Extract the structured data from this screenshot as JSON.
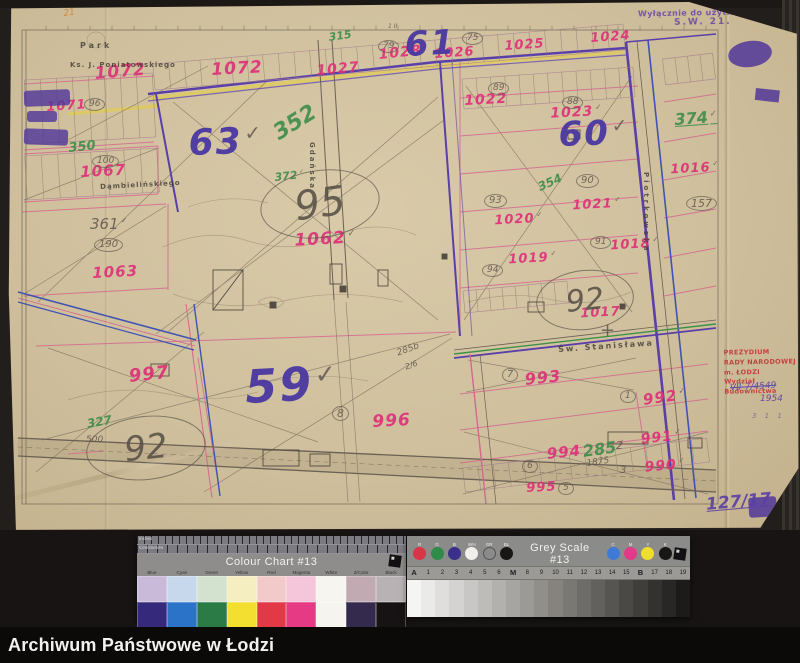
{
  "footer": {
    "archive_name": "Archiwum Państwowe w Łodzi"
  },
  "map": {
    "stamp_service": {
      "line1": "Wyłącznie do użytku służbowego",
      "line2": "S.W. 21."
    },
    "stamp_office": {
      "line1": "PREZYDIUM",
      "line2": "RADY NARODOWEJ m. ŁODZI",
      "line3": "Wydział Budownictwa"
    },
    "refs": {
      "crossed": "VII-7/4549",
      "below": "1954",
      "inventory": "127/17",
      "corner": "21",
      "extra": "3 1 1"
    },
    "street_labels": [
      {
        "t": "Park",
        "x": 72,
        "y": 40,
        "s": 8,
        "ls": 3
      },
      {
        "t": "Ks. J. Poniatowskiego",
        "x": 62,
        "y": 60,
        "s": 7,
        "ls": 1
      },
      {
        "t": "Dąmbielińskiego",
        "x": 92,
        "y": 182,
        "s": 7,
        "ls": 1,
        "r": -3
      },
      {
        "t": "Gdańska",
        "x": 300,
        "y": 140,
        "s": 7,
        "ls": 2,
        "vert": 1
      },
      {
        "t": "Piotrkowska",
        "x": 634,
        "y": 170,
        "s": 7,
        "ls": 3,
        "vert": 1
      },
      {
        "t": "Św. Stanisława",
        "x": 550,
        "y": 344,
        "s": 8,
        "ls": 2,
        "r": -4
      }
    ],
    "district_numbers": [
      {
        "t": "61",
        "x": 396,
        "y": 26,
        "s": 34,
        "r": -3
      },
      {
        "t": "63",
        "x": 180,
        "y": 124,
        "s": 36,
        "r": -2,
        "v": 1
      },
      {
        "t": "60",
        "x": 550,
        "y": 116,
        "s": 34,
        "r": -2,
        "v": 1
      },
      {
        "t": "59",
        "x": 236,
        "y": 362,
        "s": 46,
        "r": -3,
        "v": 1
      }
    ],
    "parcel_numbers": [
      {
        "t": "1072",
        "x": 86,
        "y": 64,
        "s": 17,
        "r": -5
      },
      {
        "t": "1072",
        "x": 203,
        "y": 60,
        "s": 17,
        "r": -3
      },
      {
        "t": "1071",
        "x": 38,
        "y": 99,
        "s": 13,
        "r": -4
      },
      {
        "t": "1067",
        "x": 72,
        "y": 163,
        "s": 15,
        "r": -3
      },
      {
        "t": "1063",
        "x": 84,
        "y": 264,
        "s": 15,
        "r": -3
      },
      {
        "t": "1062",
        "x": 286,
        "y": 230,
        "s": 17,
        "r": -3,
        "v": 1
      },
      {
        "t": "1027",
        "x": 308,
        "y": 62,
        "s": 14,
        "r": -5
      },
      {
        "t": "1028",
        "x": 370,
        "y": 46,
        "s": 14,
        "r": -6
      },
      {
        "t": "1026",
        "x": 426,
        "y": 46,
        "s": 13,
        "r": -4
      },
      {
        "t": "1025",
        "x": 496,
        "y": 38,
        "s": 13,
        "r": -4
      },
      {
        "t": "1024",
        "x": 582,
        "y": 30,
        "s": 13,
        "r": -4
      },
      {
        "t": "1022",
        "x": 456,
        "y": 92,
        "s": 14,
        "r": -3
      },
      {
        "t": "1023",
        "x": 542,
        "y": 104,
        "s": 14,
        "r": -3,
        "v": 1
      },
      {
        "t": "1021",
        "x": 564,
        "y": 196,
        "s": 13,
        "r": -3,
        "v": 1
      },
      {
        "t": "1020",
        "x": 486,
        "y": 211,
        "s": 13,
        "r": -3,
        "v": 1
      },
      {
        "t": "1019",
        "x": 500,
        "y": 250,
        "s": 13,
        "r": -3,
        "v": 1
      },
      {
        "t": "1018",
        "x": 602,
        "y": 236,
        "s": 13,
        "r": -3,
        "v": 1
      },
      {
        "t": "1017",
        "x": 572,
        "y": 304,
        "s": 13,
        "r": -3,
        "v": 1
      },
      {
        "t": "1016",
        "x": 662,
        "y": 160,
        "s": 13,
        "r": -3,
        "v": 1
      },
      {
        "t": "997",
        "x": 120,
        "y": 366,
        "s": 18,
        "r": -6
      },
      {
        "t": "996",
        "x": 364,
        "y": 412,
        "s": 17,
        "r": -3
      },
      {
        "t": "993",
        "x": 516,
        "y": 370,
        "s": 16,
        "r": -6
      },
      {
        "t": "992",
        "x": 634,
        "y": 390,
        "s": 15,
        "r": -8,
        "v": 1
      },
      {
        "t": "994",
        "x": 538,
        "y": 444,
        "s": 15,
        "r": -6,
        "v": 1
      },
      {
        "t": "991",
        "x": 632,
        "y": 430,
        "s": 14,
        "r": -6,
        "v": 1
      },
      {
        "t": "990",
        "x": 636,
        "y": 458,
        "s": 14,
        "r": -5,
        "v": 1
      },
      {
        "t": "995",
        "x": 518,
        "y": 480,
        "s": 13,
        "r": -3
      }
    ],
    "green_numbers": [
      {
        "t": "350",
        "x": 60,
        "y": 140,
        "s": 13,
        "r": -6
      },
      {
        "t": "315",
        "x": 320,
        "y": 30,
        "s": 11,
        "r": -8
      },
      {
        "t": "352",
        "x": 262,
        "y": 124,
        "s": 22,
        "r": -32
      },
      {
        "t": "372",
        "x": 266,
        "y": 170,
        "s": 11,
        "r": -6,
        "v": 1
      },
      {
        "t": "374",
        "x": 666,
        "y": 110,
        "s": 16,
        "r": -4,
        "u": 1,
        "v": 1
      },
      {
        "t": "354",
        "x": 528,
        "y": 180,
        "s": 12,
        "r": -24
      },
      {
        "t": "327",
        "x": 78,
        "y": 416,
        "s": 12,
        "r": -10
      },
      {
        "t": "285",
        "x": 574,
        "y": 442,
        "s": 16,
        "r": -8,
        "v": 1
      }
    ],
    "pencil_numbers": [
      {
        "t": "96",
        "x": 76,
        "y": 96,
        "s": 9,
        "c": 1
      },
      {
        "t": "79",
        "x": 370,
        "y": 38,
        "s": 9,
        "c": 1
      },
      {
        "t": "75",
        "x": 454,
        "y": 30,
        "s": 9,
        "c": 1
      },
      {
        "t": "89",
        "x": 480,
        "y": 80,
        "s": 9,
        "c": 1
      },
      {
        "t": "88",
        "x": 554,
        "y": 94,
        "s": 9,
        "c": 1
      },
      {
        "t": "93",
        "x": 476,
        "y": 192,
        "s": 10,
        "c": 1
      },
      {
        "t": "90",
        "x": 568,
        "y": 172,
        "s": 10,
        "c": 1
      },
      {
        "t": "91",
        "x": 582,
        "y": 234,
        "s": 9,
        "c": 1
      },
      {
        "t": "94",
        "x": 474,
        "y": 262,
        "s": 9,
        "c": 1
      },
      {
        "t": "157",
        "x": 678,
        "y": 194,
        "s": 11,
        "c": 1
      },
      {
        "t": "100",
        "x": 84,
        "y": 153,
        "s": 9,
        "c": 1
      },
      {
        "t": "190",
        "x": 86,
        "y": 236,
        "s": 10,
        "c": 1
      },
      {
        "t": "361",
        "x": 82,
        "y": 214,
        "s": 15,
        "v": 1
      },
      {
        "t": "500",
        "x": 78,
        "y": 434,
        "s": 9
      },
      {
        "t": "8",
        "x": 324,
        "y": 404,
        "s": 11,
        "c": 1
      },
      {
        "t": "7",
        "x": 494,
        "y": 366,
        "s": 10,
        "c": 1
      },
      {
        "t": "1",
        "x": 612,
        "y": 388,
        "s": 9,
        "c": 1
      },
      {
        "t": "6",
        "x": 514,
        "y": 458,
        "s": 9,
        "c": 1
      },
      {
        "t": "5",
        "x": 550,
        "y": 480,
        "s": 9,
        "c": 1
      },
      {
        "t": "2",
        "x": 608,
        "y": 438,
        "s": 11
      },
      {
        "t": "3",
        "x": 612,
        "y": 464,
        "s": 10
      },
      {
        "t": "1875",
        "x": 578,
        "y": 458,
        "s": 9,
        "r": -8
      },
      {
        "t": "285b",
        "x": 388,
        "y": 348,
        "s": 9,
        "r": -20
      },
      {
        "t": "2/6",
        "x": 396,
        "y": 362,
        "s": 8,
        "r": -20
      },
      {
        "t": "+",
        "x": 592,
        "y": 320,
        "s": 18
      },
      {
        "t": "1 II",
        "x": 380,
        "y": 22,
        "s": 6
      }
    ],
    "ellipse_numbers": [
      {
        "t": "95",
        "x": 252,
        "y": 168,
        "w": 118,
        "h": 66,
        "s": 40,
        "r": -8
      },
      {
        "t": "92",
        "x": 528,
        "y": 268,
        "w": 96,
        "h": 58,
        "s": 30,
        "r": -6
      },
      {
        "t": "92",
        "x": 78,
        "y": 414,
        "w": 118,
        "h": 62,
        "s": 34,
        "r": -6
      }
    ]
  },
  "colour_chart": {
    "title": "Colour Chart #13",
    "ruler_top_label": "Inches",
    "ruler_bottom_label": "Centimetres",
    "columns": [
      {
        "label": "Blue",
        "pastel": "#c9bada",
        "solid": "#35297b"
      },
      {
        "label": "Cyan",
        "pastel": "#c8d8ec",
        "solid": "#2b73c9"
      },
      {
        "label": "Green",
        "pastel": "#d2e2cf",
        "solid": "#2a7b45"
      },
      {
        "label": "Yellow",
        "pastel": "#f4eec1",
        "solid": "#f2df2f"
      },
      {
        "label": "Red",
        "pastel": "#f2cac9",
        "solid": "#e23946"
      },
      {
        "label": "Magenta",
        "pastel": "#f5c5d9",
        "solid": "#e63a85"
      },
      {
        "label": "White",
        "pastel": "#f7f5f0",
        "solid": "#f6f4ee"
      },
      {
        "label": "3/Color",
        "pastel": "#c1aab2",
        "solid": "#332a4e"
      },
      {
        "label": "Black",
        "pastel": "#b9b2b4",
        "solid": "#171314"
      }
    ]
  },
  "grey_scale": {
    "title": "Grey Scale #13",
    "dots_left": [
      {
        "label": "R",
        "color": "#d93448"
      },
      {
        "label": "G",
        "color": "#2f8b47"
      },
      {
        "label": "B",
        "color": "#3b2f8e"
      },
      {
        "label": "WH",
        "color": "#f2f0ea"
      },
      {
        "label": "GR",
        "color": "ring"
      },
      {
        "label": "BL",
        "color": "#191617"
      }
    ],
    "dots_right": [
      {
        "label": "C",
        "color": "#3f7bd6"
      },
      {
        "label": "M",
        "color": "#e23a88"
      },
      {
        "label": "Y",
        "color": "#efdf2c"
      },
      {
        "label": "K",
        "color": "#191617"
      }
    ],
    "scale_labels": [
      "A",
      "1",
      "2",
      "3",
      "4",
      "5",
      "6",
      "M",
      "8",
      "9",
      "10",
      "11",
      "12",
      "13",
      "14",
      "15",
      "B",
      "17",
      "18",
      "19"
    ]
  }
}
